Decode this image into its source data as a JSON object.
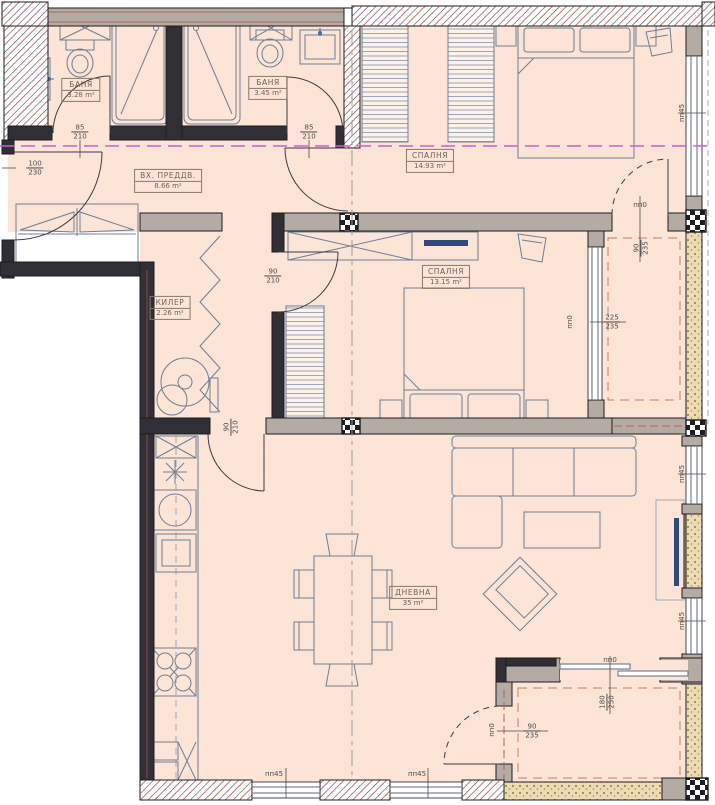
{
  "plan": {
    "rooms": [
      {
        "name": "БАНЯ",
        "area": "3.28 m²"
      },
      {
        "name": "БАНЯ",
        "area": "3.45 m²"
      },
      {
        "name": "ВХ. ПРЕДДВ.",
        "area": "8.66 m²"
      },
      {
        "name": "СПАЛНЯ",
        "area": "14.93 m²"
      },
      {
        "name": "КИЛЕР",
        "area": "2.26 m²"
      },
      {
        "name": "СПАЛНЯ",
        "area": "13.15 m²"
      },
      {
        "name": "ДНЕВНА",
        "area": "35 m²"
      }
    ],
    "door_dims": [
      {
        "w": "85",
        "h": "210"
      },
      {
        "w": "85",
        "h": "210"
      },
      {
        "w": "100",
        "h": "230"
      },
      {
        "w": "90",
        "h": "210"
      },
      {
        "w": "90",
        "h": "210"
      },
      {
        "w": "90",
        "h": "235"
      },
      {
        "w": "225",
        "h": "235"
      },
      {
        "w": "180",
        "h": "250"
      },
      {
        "w": "90",
        "h": "235"
      }
    ],
    "openings": [
      {
        "text": "пп45"
      },
      {
        "text": "пп45"
      },
      {
        "text": "пп45"
      },
      {
        "text": "пп45"
      },
      {
        "text": "пп45"
      },
      {
        "text": "пп0"
      },
      {
        "text": "пп0"
      },
      {
        "text": "пп0"
      },
      {
        "text": "пп0"
      }
    ],
    "colors": {
      "floor": "#fce4d6",
      "wall_dark": "#2f2f35",
      "wall_gray": "#b4aba4",
      "hatch_line": "#4a4a4a",
      "hatch_red": "#b0514b",
      "magenta_axis": "#cf5fd0",
      "red_dash": "#b0614f",
      "furniture": "#6e7f96",
      "stipple_bg": "#ecdcb6",
      "stipple_dot": "#a5884e"
    }
  }
}
